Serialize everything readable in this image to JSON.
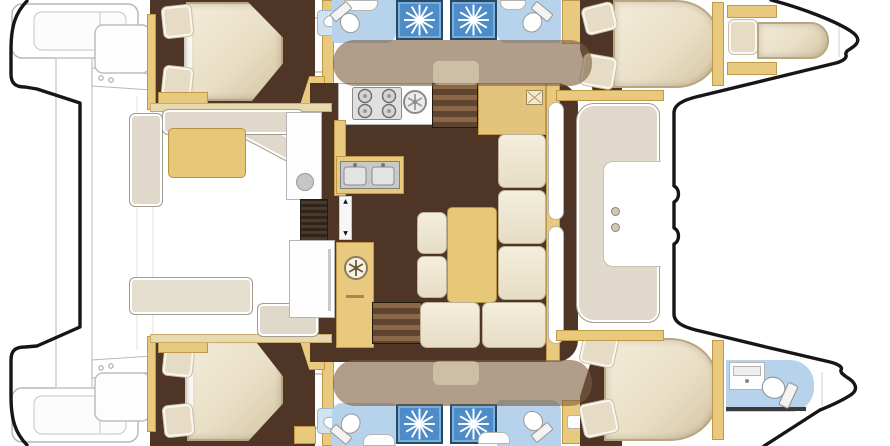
{
  "meta": {
    "description": "Top-down interior layout floor plan of a four-cabin sailing catamaran: twin hulls with cabins and bathrooms, central bridgedeck salon with galley and dinette, aft cockpit with table, transom steps and davits aft, forward cockpit seat and trampoline area at the bows. No text labels are rendered in the drawing.",
    "canvas": {
      "width": 890,
      "height": 446
    }
  },
  "palette": {
    "background": "#ffffff",
    "hull_outline": "#161616",
    "deck_line": "#b8b8b8",
    "floor_dark": "#4e3526",
    "wood": "#e9c97e",
    "wood_dark": "#bf9848",
    "table_wood": "#e7c878",
    "cushion_cream": "#eee6d0",
    "bed_cream": "#e9dfc6",
    "pillow": "#e6dcc6",
    "seat_gray": "#dfd8cb",
    "bath_floor_blue": "#b7d3ec",
    "shower_blue": "#4d8cc6",
    "shower_border": "#2a4a63",
    "stainless": "#d9d9d9",
    "coachroof_shade": "rgba(124,94,62,0.6)"
  },
  "inventory": {
    "double_beds": 4,
    "single_bow_berths": 1,
    "bathrooms": 5,
    "shower_stalls": 4,
    "toilets": 5,
    "stove_burners": 4,
    "galley_sink_basins": 2,
    "companionway_staircases": 2,
    "dinette_tables": 1,
    "cockpit_tables": 1,
    "forward_cockpit_seats": 1,
    "transom_platforms": 2
  },
  "glyphs": [
    "starburst-shower-drain-icon",
    "round-hatch-wheel-icon",
    "stove-burners-icon",
    "double-sink-icon",
    "toilet-icon",
    "companionway-arrow-icon"
  ]
}
